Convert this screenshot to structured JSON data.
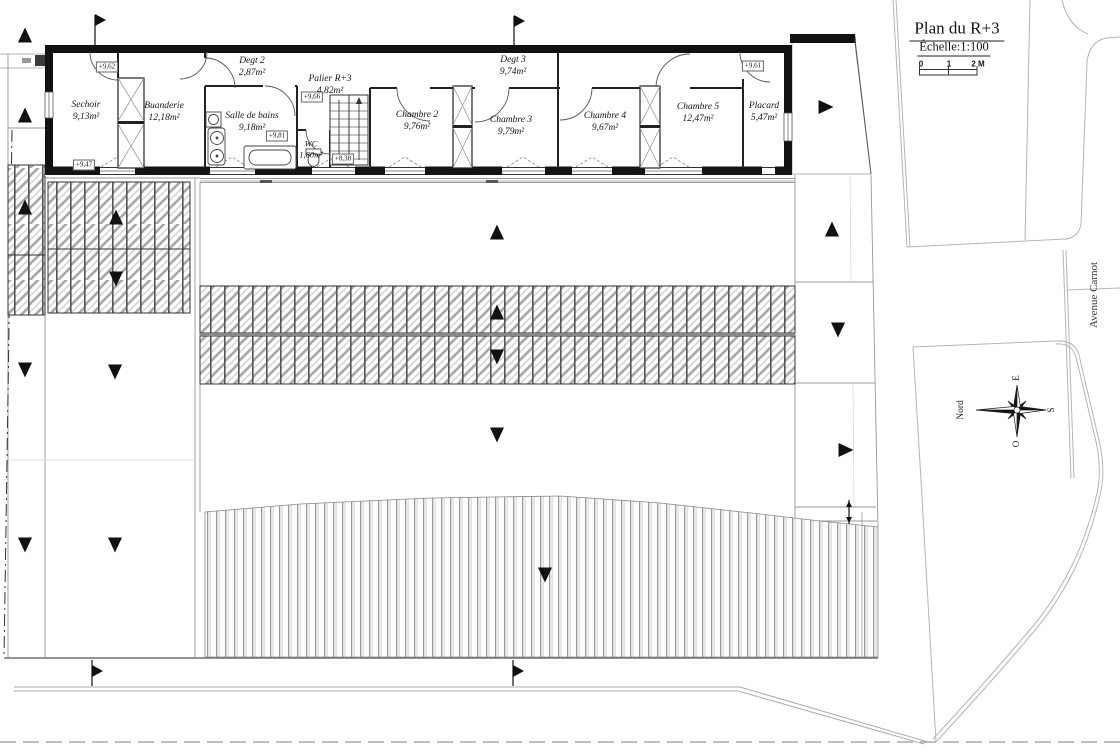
{
  "title_block": {
    "title": "Plan du R+3",
    "scale_label": "Échelle:1:100",
    "scale_ticks": [
      "0",
      "1",
      "2 M"
    ]
  },
  "street_label": "Avenue Carnot",
  "compass": {
    "north": "Nord",
    "east": "E",
    "south": "S",
    "west": "O"
  },
  "rooms": [
    {
      "name": "Sechoir",
      "area": "9,13m²"
    },
    {
      "name": "Buanderie",
      "area": "12,18m²"
    },
    {
      "name": "Degt 2",
      "area": "2,87m²"
    },
    {
      "name": "Salle de bains",
      "area": "9,18m²"
    },
    {
      "name": "Palier R+3",
      "area": "4,82m²"
    },
    {
      "name": "WC",
      "area": "1,80m²"
    },
    {
      "name": "Degt 3",
      "area": "9,74m²"
    },
    {
      "name": "Chambre 2",
      "area": "9,76m²"
    },
    {
      "name": "Chambre 3",
      "area": "9,79m²"
    },
    {
      "name": "Chambre 4",
      "area": "9,67m²"
    },
    {
      "name": "Chambre 5",
      "area": "12,47m²"
    },
    {
      "name": "Placard",
      "area": "5,47m²"
    }
  ],
  "levels": [
    "+9,62",
    "+9,47",
    "+9,81",
    "+9,66",
    "+8,38",
    "+9,61"
  ],
  "drawing_colors": {
    "walls": "#141414",
    "site_lines": "#b5b5b5",
    "hatch": "#9a9a9a"
  }
}
